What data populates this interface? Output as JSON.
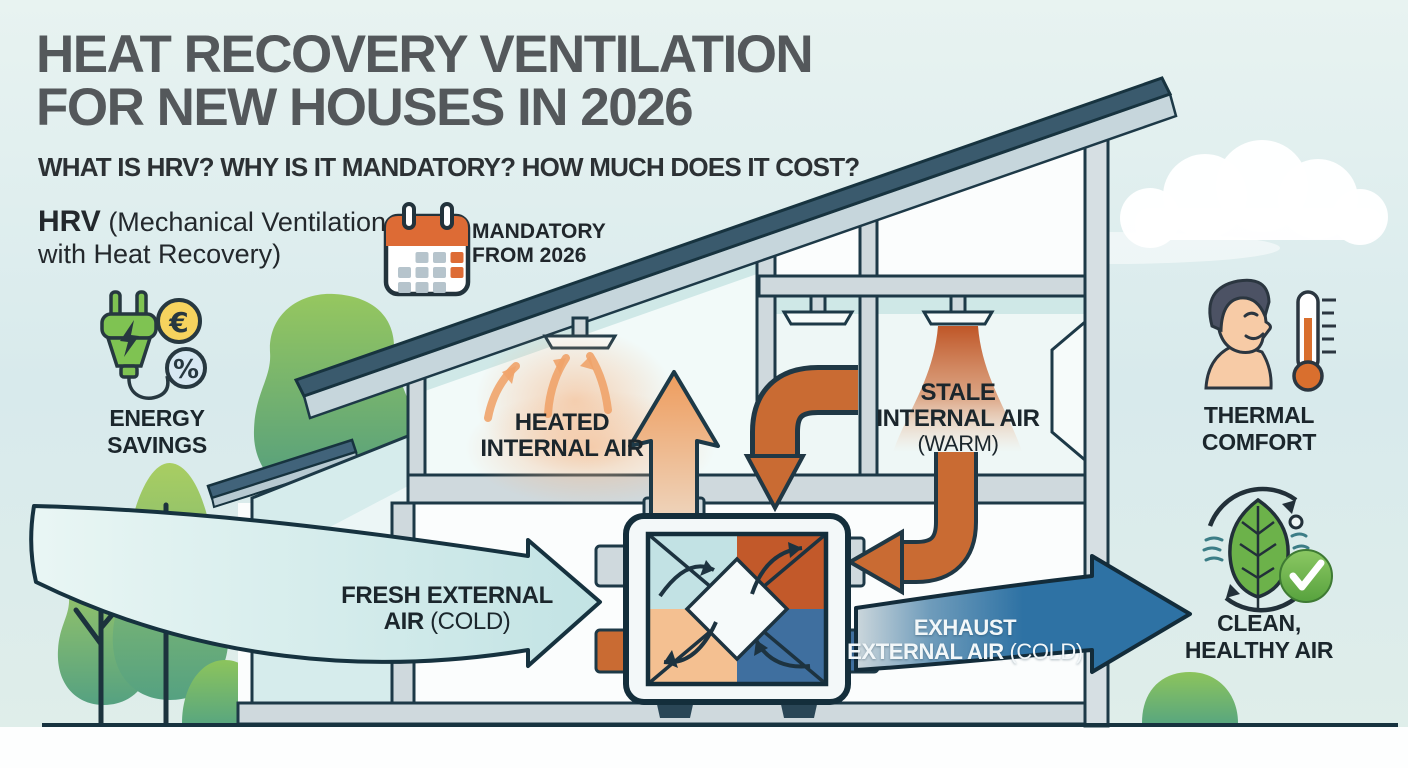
{
  "title": {
    "line1": "HEAT RECOVERY VENTILATION",
    "line2": "FOR NEW HOUSES IN 2026",
    "subtitle": "WHAT IS HRV? WHY IS IT MANDATORY? HOW MUCH DOES IT COST?"
  },
  "definition": {
    "term": "HRV",
    "line1_rest": " (Mechanical Ventilation",
    "line2": "with Heat Recovery)"
  },
  "badge": {
    "line1": "MANDATORY",
    "line2": "FROM 2026"
  },
  "benefits": {
    "energy": {
      "line1": "ENERGY",
      "line2": "SAVINGS"
    },
    "thermal": {
      "line1": "THERMAL",
      "line2": "COMFORT"
    },
    "clean": {
      "line1": "CLEAN,",
      "line2": "HEALTHY AIR"
    }
  },
  "airflows": {
    "heated": {
      "line1": "HEATED",
      "line2": "INTERNAL AIR"
    },
    "stale": {
      "line1": "STALE",
      "line2": "INTERNAL AIR",
      "line3": "(WARM)"
    },
    "fresh": {
      "line1": "FRESH EXTERNAL",
      "line2_bold": "AIR",
      "line2_note": "(COLD)"
    },
    "exhaust": {
      "line1": "EXHAUST",
      "line2_bold": "EXTERNAL AIR",
      "line2_note": "(COLD)"
    }
  },
  "icons": {
    "euro": "€",
    "percent": "%",
    "calendar": "calendar-icon",
    "plug": "power-plug-icon",
    "person": "person-profile-icon",
    "thermometer": "thermometer-icon",
    "leaf_cycle": "leaf-recycle-icon",
    "check": "check-icon"
  },
  "colors": {
    "accent_orange": "#c96b33",
    "duct_blue": "#2e72a4",
    "fresh_air": "#cdeaea",
    "leaf_green": "#6cb24a",
    "roof_slate": "#3a5a6d",
    "sky": "#dcecec"
  }
}
